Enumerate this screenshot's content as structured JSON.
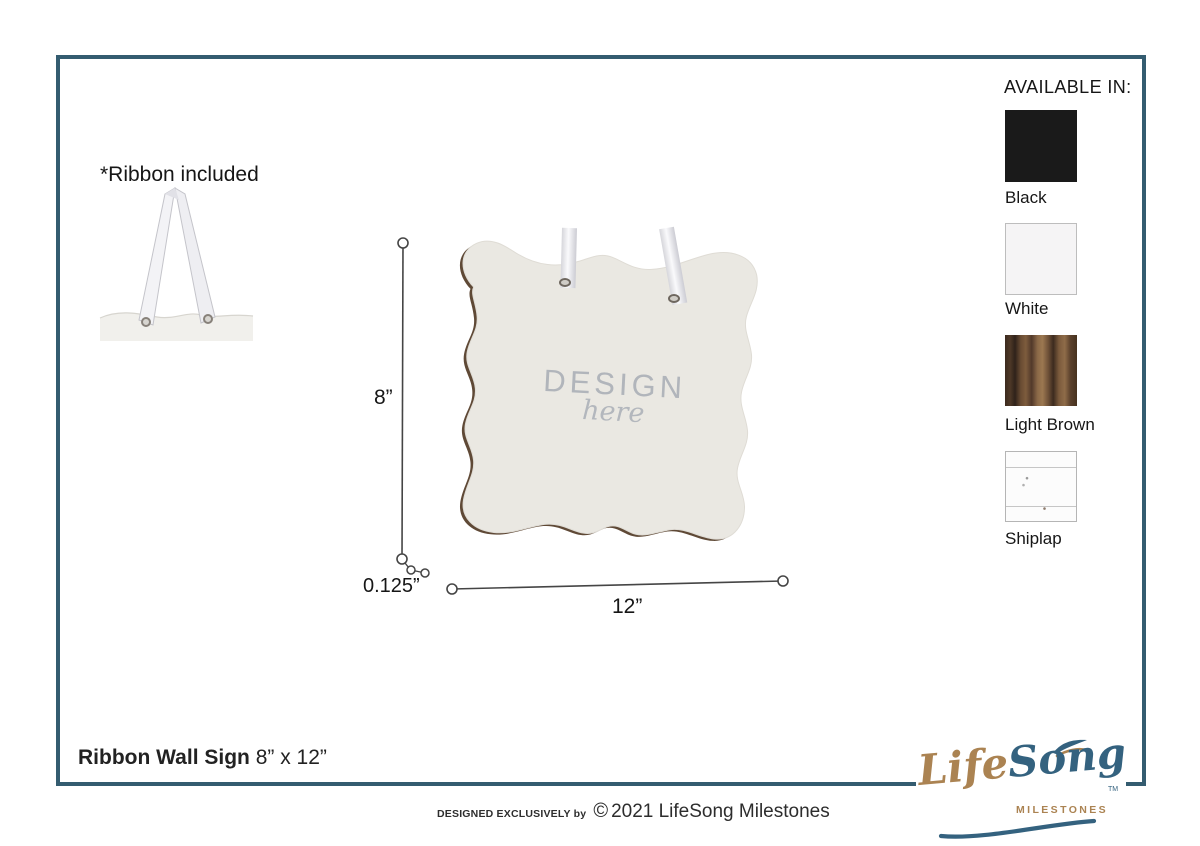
{
  "ribbon_note": "*Ribbon included",
  "sign": {
    "placeholder_line1": "DESIGN",
    "placeholder_line2": "here"
  },
  "dimensions": {
    "height": "8”",
    "thickness": "0.125”",
    "width": "12”"
  },
  "available_in": {
    "heading": "AVAILABLE IN:",
    "options": [
      {
        "label": "Black",
        "color": "#1a1a1a"
      },
      {
        "label": "White",
        "color": "#f5f4f5"
      },
      {
        "label": "Light Brown",
        "color": "#6a4c33"
      },
      {
        "label": "Shiplap",
        "color": "#fcfcfc"
      }
    ]
  },
  "footer": {
    "product_name": "Ribbon Wall Sign",
    "product_size": " 8” x 12”",
    "designed_by_small": "DESIGNED EXCLUSIVELY by",
    "copyright_symbol": "©",
    "designed_by_rest": "2021 LifeSong Milestones"
  },
  "logo": {
    "life": "Life",
    "song": "Song",
    "tm": "TM",
    "milestones": "MILESTONES"
  },
  "colors": {
    "frame": "#345c70",
    "logo_gold": "#ab8352",
    "logo_blue": "#34627f",
    "sign_fill": "#eae8e2",
    "sign_edge": "#5f4936",
    "design_text": "#b1b5bb",
    "dimension_line": "#454545"
  }
}
